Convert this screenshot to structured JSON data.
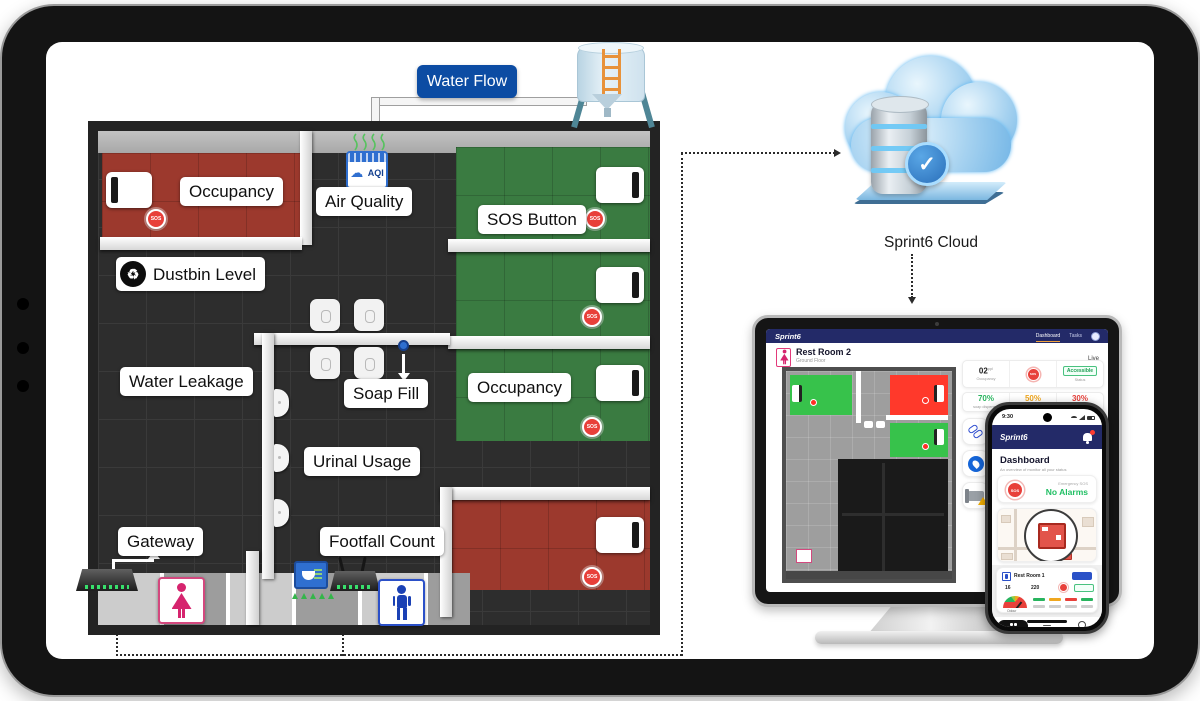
{
  "icons": {
    "cloud": "☁",
    "recycle": "♻",
    "check": "✓"
  },
  "colors": {
    "brand_navy": "#232a68",
    "accent_blue": "#0c4ca3",
    "sos_red": "#e8403a",
    "ok_green": "#27b45e",
    "warn_amber": "#f0a71f",
    "stall_green": "#3a7b41",
    "stall_red": "#9c392d"
  },
  "diagram": {
    "water_flow_label": "Water Flow",
    "cloud_caption": "Sprint6 Cloud",
    "floorplan": {
      "occupancy_top": "Occupancy",
      "air_quality": "Air Quality",
      "sos_button": "SOS Button",
      "dustbin_level": "Dustbin Level",
      "water_leakage": "Water Leakage",
      "soap_fill": "Soap Fill",
      "occupancy_right": "Occupancy",
      "urinal_usage": "Urinal Usage",
      "gateway": "Gateway",
      "footfall_count": "Footfall Count",
      "sos": "SOS",
      "aqi": "AQI"
    }
  },
  "monitor": {
    "brand": "Sprint6",
    "nav": {
      "dashboard": "Dashboard",
      "tasks": "Tasks"
    },
    "room": {
      "title": "Rest Room 2",
      "floor": "Ground Floor",
      "action": "Live"
    },
    "stats": {
      "occupancy_value": "02",
      "occupancy_unit": "ppl",
      "occupancy_label": "Occupancy",
      "sos": "SOS",
      "access_value": "Accessible",
      "access_label": "Status"
    },
    "levels": {
      "l1_value": "70%",
      "l1_label": "soap dispenser",
      "l2_value": "50%",
      "l2_label": "Trash",
      "l3_value": "30%",
      "l3_label": "paper roll"
    }
  },
  "phone": {
    "time": "9:30",
    "brand": "Sprint6",
    "title": "Dashboard",
    "subtitle": "An overview of monitor all your status",
    "sos": "SOS",
    "emergency_label": "Emergency SOS",
    "alarms": "No Alarms",
    "room": {
      "title": "Rest Room 1",
      "stat1": "16",
      "stat2": "220",
      "gauge_label": "Odour"
    },
    "nav": {
      "dashboard": "Dashboard",
      "tasks": "Tasks",
      "profile": "Profile"
    }
  }
}
